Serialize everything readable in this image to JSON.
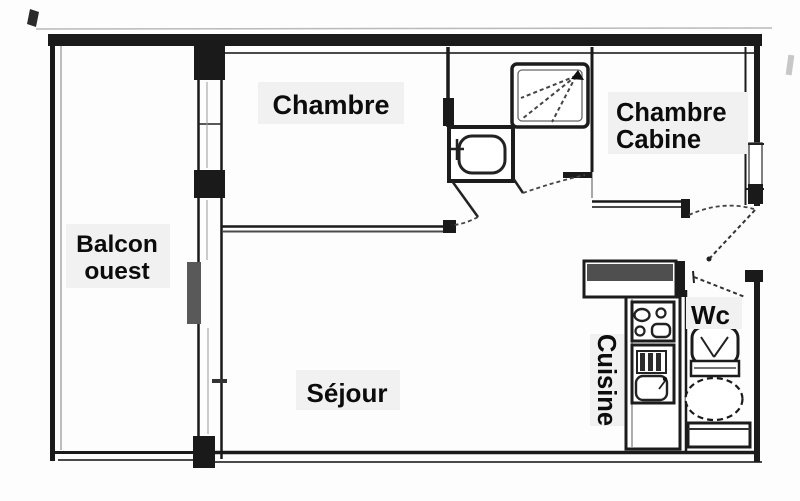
{
  "plan": {
    "type": "apartment-floor-plan",
    "rooms": {
      "balcony": {
        "label_line1": "Balcon",
        "label_line2": "ouest"
      },
      "bedroom": {
        "label": "Chambre"
      },
      "cabin_bedroom": {
        "label_line1": "Chambre",
        "label_line2": "Cabine"
      },
      "living_room": {
        "label": "Séjour"
      },
      "kitchen": {
        "label": "Cuisine"
      },
      "wc": {
        "label": "Wc"
      }
    },
    "colors": {
      "wall": "#1a1a1a",
      "background": "#fdfdfd",
      "glass_panel": "#595959",
      "counter_fill": "#4f4f4f",
      "label_text": "#0c0c0c"
    }
  }
}
